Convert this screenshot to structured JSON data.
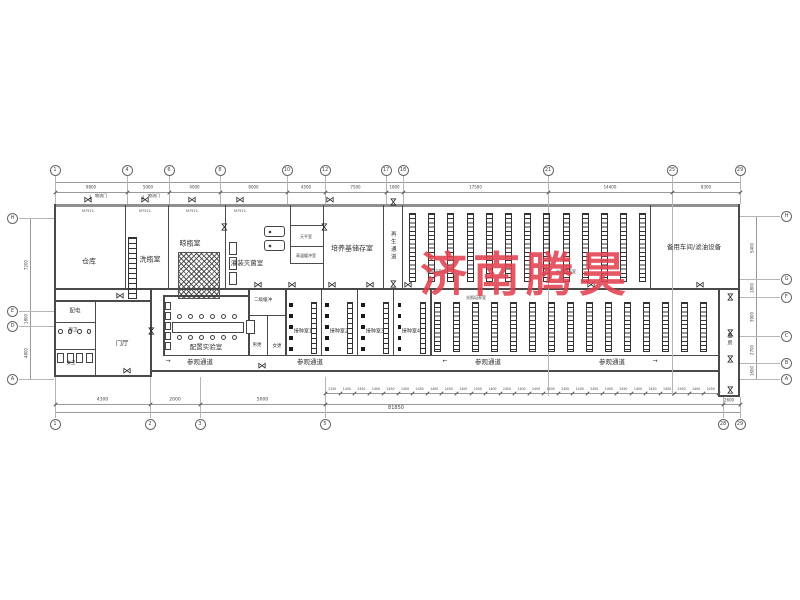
{
  "watermark": {
    "text": "济南腾昊",
    "color": "#e24250"
  },
  "rooms": {
    "cangku": "仓库",
    "xipingshi": "洗瓶室",
    "liangpingshi": "晾瓶室",
    "guanzhuang": "灌装灭菌室",
    "tianping": "天平室",
    "gaowenhuanchong": "高温缓冲室",
    "peiyangji": "培养基储存室",
    "beiyong": "备用车间/滤油设备",
    "peidian": "配电",
    "nanwei": "男卫",
    "nvwei": "女卫",
    "menting": "门厅",
    "peizhi": "配置实验室",
    "erjihuanchong": "二级缓冲",
    "nangeng": "男更",
    "nvgeng": "女更",
    "jiezhong": [
      "接种室1",
      "接种室2",
      "接种室3",
      "接种室4"
    ],
    "guangzhao": "光照培养室"
  },
  "corridors": {
    "canguan": "参观通道",
    "zaisheng": "再生通道",
    "liangfang": "量房"
  },
  "annotations": {
    "wuliumen": "物流门",
    "door_code": "M7521",
    "down_arrow": "↓",
    "right_arrow": "→",
    "left_arrow": "←"
  },
  "axes": {
    "top": [
      {
        "label": "1",
        "x": 55
      },
      {
        "label": "4",
        "x": 127
      },
      {
        "label": "6",
        "x": 169
      },
      {
        "label": "8",
        "x": 220
      },
      {
        "label": "10",
        "x": 287
      },
      {
        "label": "12",
        "x": 325
      },
      {
        "label": "17",
        "x": 386
      },
      {
        "label": "18",
        "x": 403
      },
      {
        "label": "21",
        "x": 548
      },
      {
        "label": "25",
        "x": 672
      },
      {
        "label": "29",
        "x": 740
      }
    ],
    "bottom": [
      {
        "label": "1",
        "x": 55
      },
      {
        "label": "2",
        "x": 150
      },
      {
        "label": "3",
        "x": 200
      },
      {
        "label": "5",
        "x": 325
      },
      {
        "label": "28",
        "x": 723
      },
      {
        "label": "29",
        "x": 740
      }
    ],
    "left": [
      {
        "label": "H",
        "y": 218
      },
      {
        "label": "E",
        "y": 311
      },
      {
        "label": "D",
        "y": 326
      },
      {
        "label": "A",
        "y": 379
      }
    ],
    "right": [
      {
        "label": "H",
        "y": 216
      },
      {
        "label": "G",
        "y": 279
      },
      {
        "label": "F",
        "y": 297
      },
      {
        "label": "C",
        "y": 336
      },
      {
        "label": "B",
        "y": 363
      },
      {
        "label": "A",
        "y": 379
      }
    ]
  },
  "dimensions": {
    "top": [
      "9800",
      "5000",
      "4000",
      "8000",
      "4500",
      "7500",
      "1800",
      "17500",
      "14400",
      "8300"
    ],
    "bottom_left": [
      "4300",
      "2000",
      "5000"
    ],
    "bottom_chain": [
      "2150",
      "1400",
      "2450",
      "1400",
      "2450",
      "1400",
      "2450",
      "1400",
      "2450",
      "1400",
      "2450",
      "1400",
      "2450",
      "1400",
      "2450",
      "1400",
      "2450",
      "1400",
      "2450",
      "1400",
      "2450",
      "1400",
      "2450",
      "1400",
      "2450",
      "1400",
      "2450"
    ],
    "bottom_right": "2600",
    "total": "81850",
    "left": [
      "7200",
      "1800",
      "4800"
    ],
    "right": [
      "5400",
      "1800",
      "3900",
      "2700",
      "1600"
    ]
  }
}
